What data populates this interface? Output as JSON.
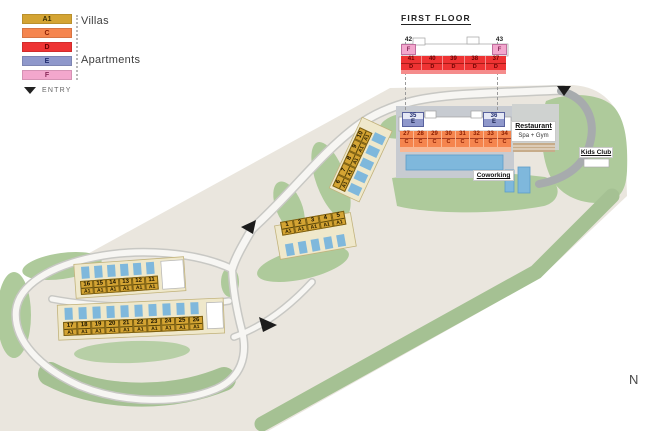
{
  "colors": {
    "villa": "#D4A433",
    "apartment_c": "#F5854E",
    "apartment_d": "#EE3333",
    "apartment_e": "#8F98CB",
    "apartment_f": "#F3A7CD",
    "pool": "#7FB8DC",
    "land": "#EAE6DE",
    "green": "#AECA9B"
  },
  "legend": {
    "items": [
      {
        "code": "A1",
        "color": "#D4A433",
        "text_color": "#3A2E00"
      },
      {
        "code": "C",
        "color": "#F5854E",
        "text_color": "#8B1D00"
      },
      {
        "code": "D",
        "color": "#EE3333",
        "text_color": "#6A0000"
      },
      {
        "code": "E",
        "color": "#8F98CB",
        "text_color": "#1F2B6E"
      },
      {
        "code": "F",
        "color": "#F3A7CD",
        "text_color": "#8A2A5A"
      }
    ],
    "villas_label": "Villas",
    "apartments_label": "Apartments",
    "entry_label": "ENTRY"
  },
  "first_floor": {
    "title": "FIRST FLOOR",
    "f_units": [
      {
        "num": "42",
        "code": "F"
      },
      {
        "num": "43",
        "code": "F"
      }
    ],
    "d_units": [
      {
        "num": "41",
        "code": "D"
      },
      {
        "num": "40",
        "code": "D"
      },
      {
        "num": "39",
        "code": "D"
      },
      {
        "num": "38",
        "code": "D"
      },
      {
        "num": "37",
        "code": "D"
      }
    ]
  },
  "ground_floor": {
    "e_units": [
      {
        "num": "35",
        "code": "E"
      },
      {
        "num": "36",
        "code": "E"
      }
    ],
    "c_units": [
      {
        "num": "27",
        "code": "C"
      },
      {
        "num": "28",
        "code": "C"
      },
      {
        "num": "29",
        "code": "C"
      },
      {
        "num": "30",
        "code": "C"
      },
      {
        "num": "31",
        "code": "C"
      },
      {
        "num": "32",
        "code": "C"
      },
      {
        "num": "33",
        "code": "C"
      },
      {
        "num": "34",
        "code": "C"
      }
    ]
  },
  "villas": {
    "hill_row": [
      {
        "num": "6",
        "code": "A1"
      },
      {
        "num": "7",
        "code": "A1"
      },
      {
        "num": "8",
        "code": "A1"
      },
      {
        "num": "9",
        "code": "A1"
      },
      {
        "num": "10",
        "code": "A1"
      }
    ],
    "mid_row": [
      {
        "num": "1",
        "code": "A1"
      },
      {
        "num": "2",
        "code": "A1"
      },
      {
        "num": "3",
        "code": "A1"
      },
      {
        "num": "4",
        "code": "A1"
      },
      {
        "num": "5",
        "code": "A1"
      }
    ],
    "west_upper_row": [
      {
        "num": "16",
        "code": "A1"
      },
      {
        "num": "15",
        "code": "A1"
      },
      {
        "num": "14",
        "code": "A1"
      },
      {
        "num": "13",
        "code": "A1"
      },
      {
        "num": "12",
        "code": "A1"
      },
      {
        "num": "11",
        "code": "A1"
      }
    ],
    "west_lower_row": [
      {
        "num": "17",
        "code": "A1"
      },
      {
        "num": "18",
        "code": "A1"
      },
      {
        "num": "19",
        "code": "A1"
      },
      {
        "num": "20",
        "code": "A1"
      },
      {
        "num": "21",
        "code": "A1"
      },
      {
        "num": "22",
        "code": "A1"
      },
      {
        "num": "23",
        "code": "A1"
      },
      {
        "num": "24",
        "code": "A1"
      },
      {
        "num": "25",
        "code": "A1"
      },
      {
        "num": "26",
        "code": "A1"
      }
    ]
  },
  "amenities": {
    "restaurant_title": "Restaurant",
    "restaurant_subtitle": "Spa + Gym",
    "kids_club": "Kids Club",
    "coworking": "Coworking"
  },
  "compass": {
    "north": "N"
  }
}
